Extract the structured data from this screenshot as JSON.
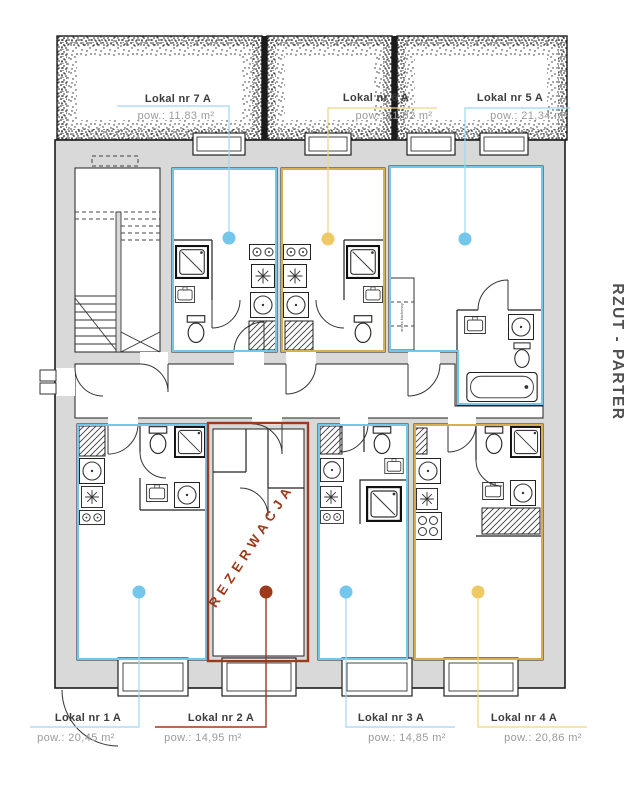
{
  "title": "RZUT - PARTER",
  "units": [
    {
      "id": "7A",
      "name": "Lokal nr 7 A",
      "area": "pow.: 11.83 m²",
      "accent": "#72c7ea"
    },
    {
      "id": "6A",
      "name": "Lokal nr 6 A",
      "area": "pow.: 11,82 m²",
      "accent": "#e9c462"
    },
    {
      "id": "5A",
      "name": "Lokal nr 5 A",
      "area": "pow.: 21,34 m²",
      "accent": "#72c7ea"
    },
    {
      "id": "1A",
      "name": "Lokal nr 1 A",
      "area": "pow.: 20,45 m²",
      "accent": "#72c7ea"
    },
    {
      "id": "2A",
      "name": "Lokal nr 2 A",
      "area": "pow.: 14,95 m²",
      "accent": "#9d3a1b",
      "status": "REZERWACJA"
    },
    {
      "id": "3A",
      "name": "Lokal nr 3 A",
      "area": "pow.: 14,85 m²",
      "accent": "#72c7ea"
    },
    {
      "id": "4A",
      "name": "Lokal nr 4 A",
      "area": "pow.: 20,86 m²",
      "accent": "#e9c462"
    }
  ],
  "annotations": {
    "kitchenette": "aneks kuchenny"
  },
  "colors": {
    "available_blue": "#72c7ea",
    "available_yellow": "#e9c462",
    "reserved_red": "#9d3a1b",
    "wall_fill": "#d9d9d9",
    "line": "#1c1c1c"
  }
}
